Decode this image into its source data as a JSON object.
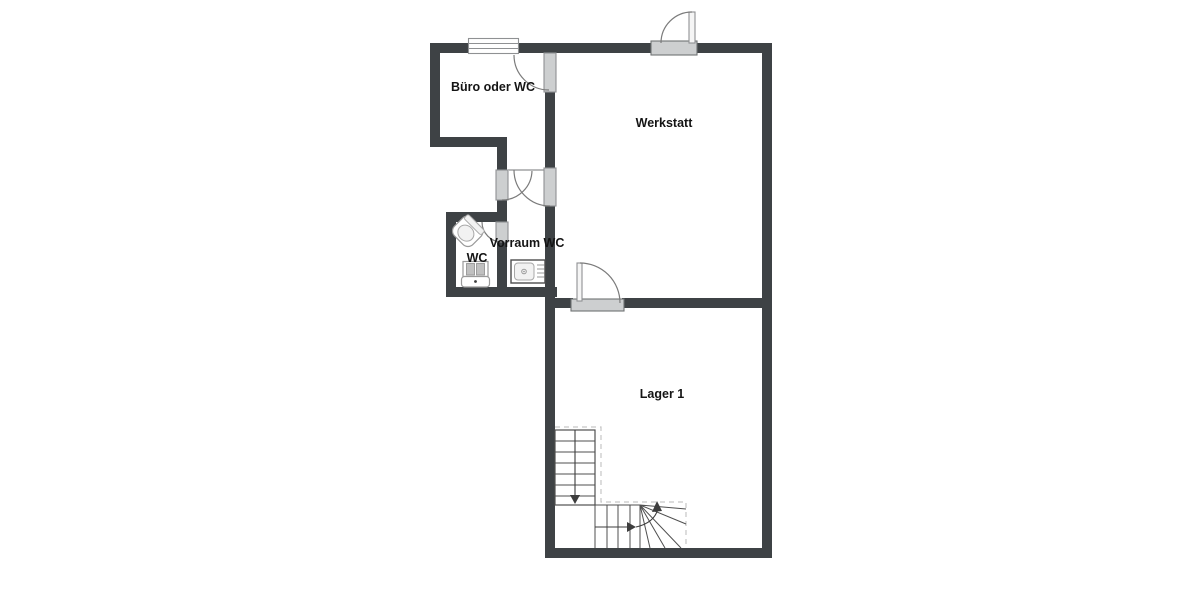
{
  "plan": {
    "rooms": {
      "buero": {
        "label": "Büro oder WC"
      },
      "werkstatt": {
        "label": "Werkstatt"
      },
      "vorraum": {
        "label": "Vorraum WC"
      },
      "wc": {
        "label": "WC"
      },
      "lager": {
        "label": "Lager 1"
      }
    },
    "fixtures": {
      "toilet": "toilet",
      "washbasin": "washbasin-with-taps",
      "sink_unit": "kitchen-sink-unit",
      "window": "window",
      "entrance_door": "exterior-swing-door",
      "stairs": "l-shaped-staircase-with-winder"
    }
  },
  "colors": {
    "wall": "#3e4245",
    "door_leaf": "#cdcfd0",
    "door_frame": "#8f9193",
    "arc": "#7b7b7b",
    "dashed": "#c6c6c6",
    "stair_line": "#4f4f4f",
    "fixture_fill": "#f2f2f2",
    "text": "#141414",
    "background": "#ffffff"
  }
}
